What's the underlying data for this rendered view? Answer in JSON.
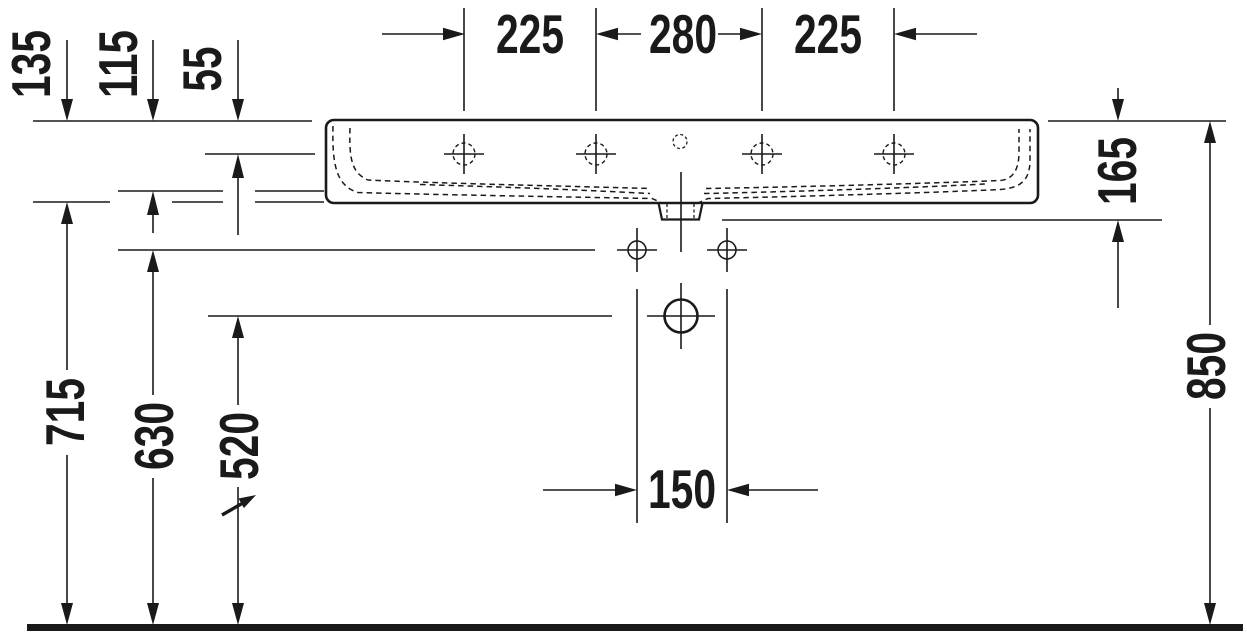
{
  "drawing": {
    "title": "washbasin front elevation dimension drawing",
    "dims": {
      "top_left": "225",
      "top_center": "280",
      "top_right": "225",
      "rim_height": "135",
      "basin_depth": "115",
      "rim_to_holes": "55",
      "floor_to_body": "715",
      "floor_to_fixings": "630",
      "floor_to_drain": "520",
      "body_outlet_height": "165",
      "floor_to_rim": "850",
      "fixing_spacing": "150"
    },
    "colors": {
      "line": "#1a1a1a",
      "background": "#ffffff"
    }
  }
}
